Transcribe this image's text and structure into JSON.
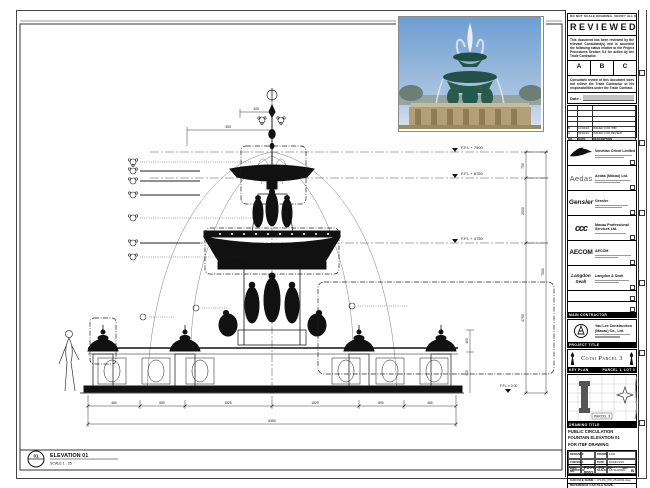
{
  "stamp": {
    "header": "DO NOT SCALE DRAWING. VERIFY ALL DIMENSIONS ON SITE.",
    "title": "REVIEWED",
    "body1": "This document has been reviewed by the relevant Consultant(s) and is accorded the following status relative to the Project Procedures Section 5.4 for action by the Trade Contractor.",
    "options": [
      "A",
      "B",
      "C"
    ],
    "body2": "Consultant review of this document does not relieve the Trade Contractor of his responsibilities under the Trade Contract.",
    "date_label": "Date :"
  },
  "revisions": {
    "headers": [
      "NO.",
      "DATE",
      "DESCRIPTION"
    ],
    "rows": [
      [
        "A",
        "05/02/16",
        "ISSUED FOR REVIEW"
      ],
      [
        "B",
        "12/04/16",
        "ISSUED FOR ITBF"
      ]
    ]
  },
  "consultants": [
    {
      "logo": "VOL",
      "name": "Venetian Orient Limited"
    },
    {
      "logo": "Aedas",
      "name": "Aedas (Macau) Ltd."
    },
    {
      "logo": "Gensler",
      "name": "Gensler"
    },
    {
      "logo": "ccc",
      "name": "Macau Professional Services Ltd."
    },
    {
      "logo": "AECOM",
      "name": "AECOM"
    },
    {
      "logo": "Langdon Seah",
      "name": "Langdon & Seah"
    }
  ],
  "contractor": {
    "header": "MAIN CONTRACTOR",
    "name": "Yau Lee Construction (Macau) Co., Ltd."
  },
  "project": {
    "header": "PROJECT TITLE",
    "title": "Cotai Parcel 3"
  },
  "keyplan": {
    "label": "KEY PLAN",
    "right": "PARCEL 1, LOT 3",
    "site": "PARCEL 3"
  },
  "titleblock": {
    "header": "DRAWING TITLE",
    "lines": [
      "PUBLIC CIRCULATION",
      "FOUNTAIN ELEVATION 01",
      "FOR ITBF DRAWING"
    ],
    "fields": {
      "designed_label": "DESIGNED",
      "designed": "",
      "drawn_label": "DRAWN",
      "drawn": "CAD",
      "checked_label": "CHECKED",
      "checked": "-",
      "date_label": "DATE",
      "date": "12/04/2016",
      "approved_label": "APPROVED",
      "approved": "-",
      "scale_label": "SCALE",
      "scale": "AS SHOWN"
    },
    "dwg_label": "DWG. NO.",
    "dwg_no": "P3-PA_PD_25-0001",
    "rev_label": "REV :",
    "rev": "B",
    "job_label": "JOB NUMBER :",
    "job": "51510",
    "cad_label": "CAD FILE NAME :",
    "cad": "P3-PA_PD_25-0001.dwg",
    "ref_label": "REFERENCE CAD FILE NAME :"
  },
  "elevation": {
    "tag": "01",
    "label": "ELEVATION 01",
    "scale": "SCALE  1 : 25"
  },
  "levels": [
    "F.F.L + 7500",
    "F.F.L + 6750",
    "F.F.L + 4750",
    "F.F.L ± 0.00"
  ],
  "dims": {
    "right": [
      "750",
      "2000",
      "4750",
      "7500"
    ],
    "top": [
      "100",
      "300"
    ],
    "bottom": [
      "460",
      "890",
      "1825",
      "1825",
      "890",
      "460"
    ],
    "bottom_total": "6350",
    "base": [
      "450",
      "900"
    ]
  },
  "colors": {
    "line": "#111111",
    "water_jet": "#777777",
    "photo_sky": "#7fa8d8",
    "photo_bronze": "#23584f",
    "photo_stone": "#b3a078"
  }
}
